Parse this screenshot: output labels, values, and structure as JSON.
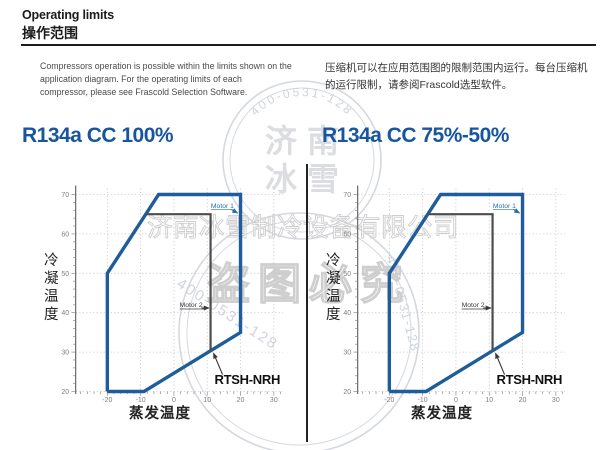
{
  "header": {
    "title_en": "Operating limits",
    "title_zh": "操作范围"
  },
  "intro": {
    "en": "Compressors operation is possible within the limits shown on the application diagram. For the operating limits of each compressor, please see Frascold Selection Software.",
    "zh": "压缩机可以在应用范围图的限制范围内运行。每台压缩机的运行限制，请参阅Frascold选型软件。"
  },
  "colors": {
    "accent_blue": "#17559f",
    "envelope_blue": "#1e5c9b",
    "motor_line_gray": "#4d4d4d",
    "axis_gray": "#5a5a5a",
    "grid_gray": "#c6c6c6",
    "watermark_gray": "#cdd2d9"
  },
  "watermark": {
    "company_line": "济南冰雪制冷设备有限公司",
    "slogan": "盗图必究",
    "phone": "400-0531-128",
    "stamp_chars": [
      "济",
      "南",
      "冰",
      "雪"
    ]
  },
  "chart_data": [
    {
      "type": "line",
      "title": "R134a CC 100%",
      "xlabel": "蒸发温度",
      "ylabel": "冷凝温度",
      "x_ticks": [
        -20,
        -10,
        0,
        10,
        20,
        30
      ],
      "y_ticks": [
        20,
        30,
        40,
        50,
        60,
        70
      ],
      "x_domain": [
        -29.5,
        33.5
      ],
      "y_domain": [
        20,
        71.5
      ],
      "grid": "dotted",
      "series": [
        {
          "name": "operating-envelope",
          "color": "#1e5c9b",
          "points": [
            [
              -20,
              20
            ],
            [
              -20,
              50
            ],
            [
              -4.6,
              70
            ],
            [
              20,
              70
            ],
            [
              20,
              35
            ],
            [
              -9,
              20
            ],
            [
              -20,
              20
            ]
          ]
        },
        {
          "name": "motor-2-limit",
          "color": "#4d4d4d",
          "points": [
            [
              -8.5,
              65
            ],
            [
              11,
              65
            ],
            [
              11,
              30.3
            ]
          ]
        }
      ],
      "annotations": {
        "motor1": {
          "label": "Motor 1",
          "pos": [
            11.1,
            66.6
          ],
          "arrow": [
            [
              17.2,
              66.2
            ],
            [
              19.1,
              65.3
            ]
          ]
        },
        "motor2": {
          "label": "Motor 2",
          "pos": [
            1.7,
            41.4
          ],
          "arrow": [
            [
              8.2,
              41.2
            ],
            [
              10.5,
              41.2
            ]
          ]
        },
        "model": {
          "label": "RTSH-NRH",
          "pos": [
            12.2,
            21.9
          ],
          "arrow": [
            [
              14.6,
              24.3
            ],
            [
              11.9,
              29.7
            ]
          ]
        }
      }
    },
    {
      "type": "line",
      "title": "R134a CC 75%-50%",
      "xlabel": "蒸发温度",
      "ylabel": "冷凝温度",
      "x_ticks": [
        -20,
        -10,
        0,
        10,
        20,
        30
      ],
      "y_ticks": [
        20,
        30,
        40,
        50,
        60,
        70
      ],
      "x_domain": [
        -29.5,
        33.5
      ],
      "y_domain": [
        20,
        71.5
      ],
      "grid": "dotted",
      "series": [
        {
          "name": "operating-envelope",
          "color": "#1e5c9b",
          "points": [
            [
              -20,
              20
            ],
            [
              -20,
              50
            ],
            [
              -4.6,
              70
            ],
            [
              20,
              70
            ],
            [
              20,
              35
            ],
            [
              -9,
              20
            ],
            [
              -20,
              20
            ]
          ]
        },
        {
          "name": "motor-2-limit",
          "color": "#4d4d4d",
          "points": [
            [
              -8.5,
              65
            ],
            [
              11,
              65
            ],
            [
              11,
              30.3
            ]
          ]
        }
      ],
      "annotations": {
        "motor1": {
          "label": "Motor 1",
          "pos": [
            11.1,
            66.6
          ],
          "arrow": [
            [
              17.2,
              66.2
            ],
            [
              19.1,
              65.3
            ]
          ]
        },
        "motor2": {
          "label": "Motor 2",
          "pos": [
            1.7,
            41.4
          ],
          "arrow": [
            [
              8.2,
              41.2
            ],
            [
              10.5,
              41.2
            ]
          ]
        },
        "model": {
          "label": "RTSH-NRH",
          "pos": [
            12.2,
            21.9
          ],
          "arrow": [
            [
              14.6,
              24.3
            ],
            [
              11.9,
              29.7
            ]
          ]
        }
      }
    }
  ]
}
